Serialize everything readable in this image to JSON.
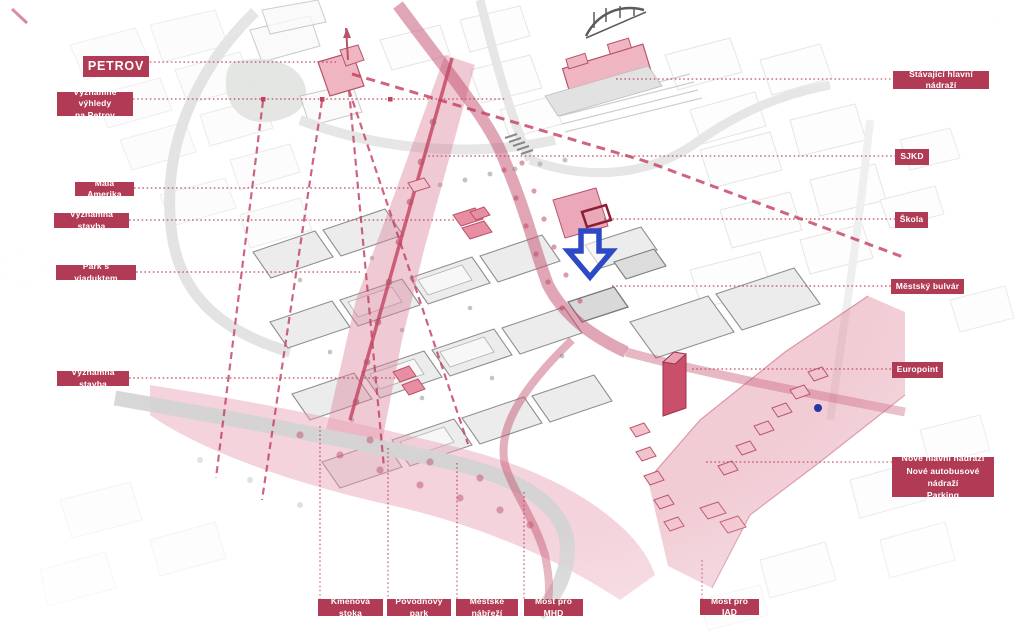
{
  "colors": {
    "label_bg": "#b13a54",
    "leader": "#c14b62",
    "sightline": "#c23e5c",
    "highlight_pink": "#dd7f97",
    "building_pink": "#efb6c2",
    "accent_crimson": "#c94f6b",
    "arrow_blue": "#2e49c4"
  },
  "callouts": {
    "left": [
      {
        "id": "petrov",
        "text": "PETROV"
      },
      {
        "id": "vyhledy",
        "text": "Významné výhledy\nna Petrov"
      },
      {
        "id": "mala_amerika",
        "text": "Malá Amerika"
      },
      {
        "id": "vyznamna_stavba_1",
        "text": "Významná stavba"
      },
      {
        "id": "park_s_viaduktem",
        "text": "Park s viaduktem"
      },
      {
        "id": "vyznamna_stavba_2",
        "text": "Významná stavba"
      }
    ],
    "right": [
      {
        "id": "stavajici_nadrazi",
        "text": "Stávající hlavní nádraží"
      },
      {
        "id": "sjkd",
        "text": "SJKD"
      },
      {
        "id": "skola",
        "text": "Škola"
      },
      {
        "id": "mestsky_bulvar",
        "text": "Městský bulvár"
      },
      {
        "id": "europoint",
        "text": "Europoint"
      },
      {
        "id": "nove_nadrazi",
        "text": "Nové hlavní nádraží\nNové autobusové nádraží\nParking"
      }
    ],
    "bottom": [
      {
        "id": "kmenova_stoka",
        "text": "Kmenová stoka"
      },
      {
        "id": "povodnovy_park",
        "text": "Povodňový park"
      },
      {
        "id": "mestske_nabrezi",
        "text": "Městské nábřeží"
      },
      {
        "id": "most_pro_mhd",
        "text": "Most pro MHD"
      },
      {
        "id": "most_pro_iad",
        "text": "Most pro IAD"
      }
    ]
  }
}
